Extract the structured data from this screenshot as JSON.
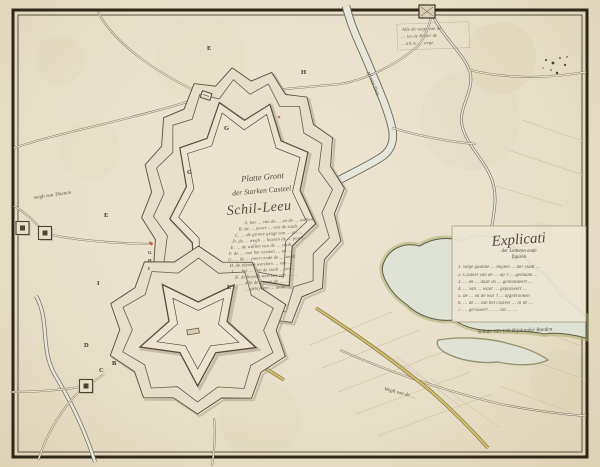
{
  "title": {
    "line1": "Platte Gront",
    "line2": "der Starken Casteel",
    "line3": "Schil-Leeu"
  },
  "legend": {
    "items": [
      "A. het … van de … en de … wallen",
      "B. de … poort … van de stadt …",
      "C. … de groote gragt van … en …",
      "D. de … wegh … buyten de … poort",
      "E. … de wallen van de … stadt …",
      "F. de … van het casteel … en …",
      "G. … de … poort ende de … wegh",
      "H. de nieuwe wercken … van …",
      "I. … het … van de stadt … en …",
      "K. de buyten wercken van … …",
      "… alle de … van de … …",
      "… geteykent … anno …"
    ]
  },
  "explicati": {
    "heading": "Explicati",
    "sub1": "der Letteren ende",
    "sub2": "figuren",
    "items": [
      "1. wege gaande … buyten … der stadt …",
      "2. Casteel van de … op 't … gemaakt …",
      "3. … en … daar de … geinondeert …",
      "4. … van … waar … gepasseert …",
      "5. de … en de wal 't … afgebrooken",
      "6. … de … van het casteel … in de …",
      "7. … geraseert … … tot … …"
    ],
    "scale": "Schale van 100 Rijnlandse Roeden"
  },
  "labels": {
    "river": "zyl van Sluis",
    "road_left": "wegh van Thienen",
    "road_bottom": "Wegh van de …",
    "annotation": [
      "Alle de wege van de",
      "… tot de Rivier de",
      "… als te … wege"
    ]
  },
  "letters": [
    {
      "char": "E"
    },
    {
      "char": "H"
    },
    {
      "char": "G"
    },
    {
      "char": "G"
    },
    {
      "char": "E"
    },
    {
      "char": "I"
    },
    {
      "char": "E"
    },
    {
      "char": "D"
    },
    {
      "char": "B"
    },
    {
      "char": "C"
    },
    {
      "char": "G"
    },
    {
      "char": "H"
    },
    {
      "char": "I"
    }
  ],
  "colors": {
    "paper": "#e8e0ca",
    "ink": "#594c3a",
    "road": "#6e6250",
    "water_fill": "#dfe3d6",
    "marsh_green": "#a9af6d",
    "route_yellow": "#d8c664",
    "frame": "#2e2718",
    "red_accent": "#b5543e"
  }
}
